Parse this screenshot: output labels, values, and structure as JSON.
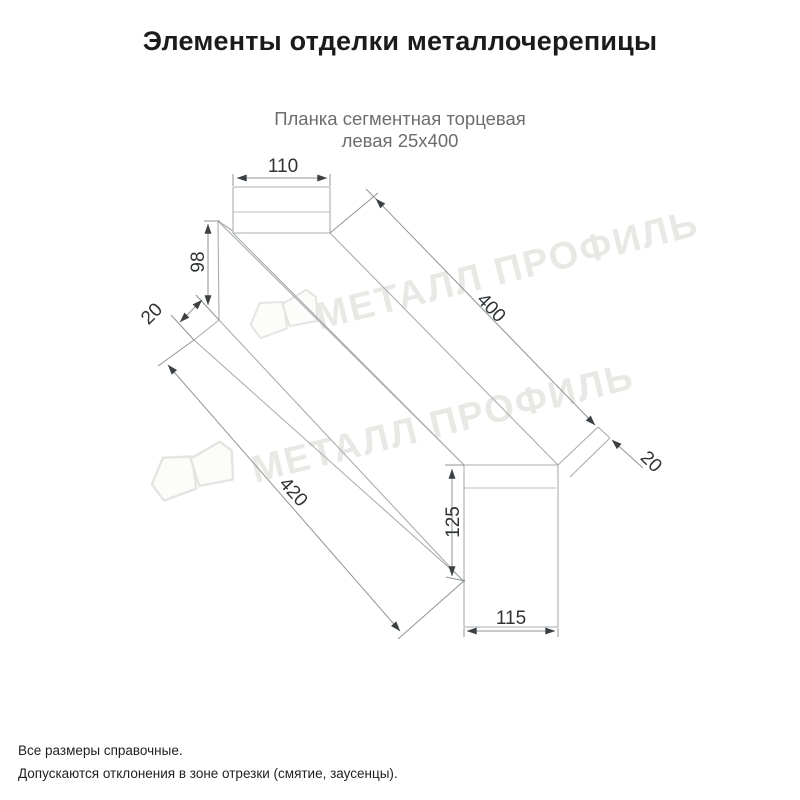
{
  "page": {
    "background": "#ffffff"
  },
  "header": {
    "title": "Элементы отделки металлочерепицы"
  },
  "product": {
    "subtitle_line1": "Планка сегментная торцевая",
    "subtitle_line2": "левая 25х400"
  },
  "drawing": {
    "type": "technical-dimension-drawing",
    "dimensions": {
      "top_flange_width": "110",
      "left_end_height": "98",
      "left_hem": "20",
      "top_length": "400",
      "right_hem": "20",
      "bottom_length": "420",
      "right_end_height": "125",
      "bottom_width": "115"
    },
    "watermark": {
      "text": "МЕТАЛЛ ПРОФИЛЬ"
    },
    "colors": {
      "outline": "#a9adaf",
      "dimension_lines": "#8f9496",
      "arrows": "#3c4043",
      "dimension_text": "#2f3336",
      "watermark": "#d8d7d1"
    }
  },
  "footer": {
    "note1": "Все размеры справочные.",
    "note2": "Допускаются отклонения в зоне отрезки (смятие, заусенцы)."
  }
}
